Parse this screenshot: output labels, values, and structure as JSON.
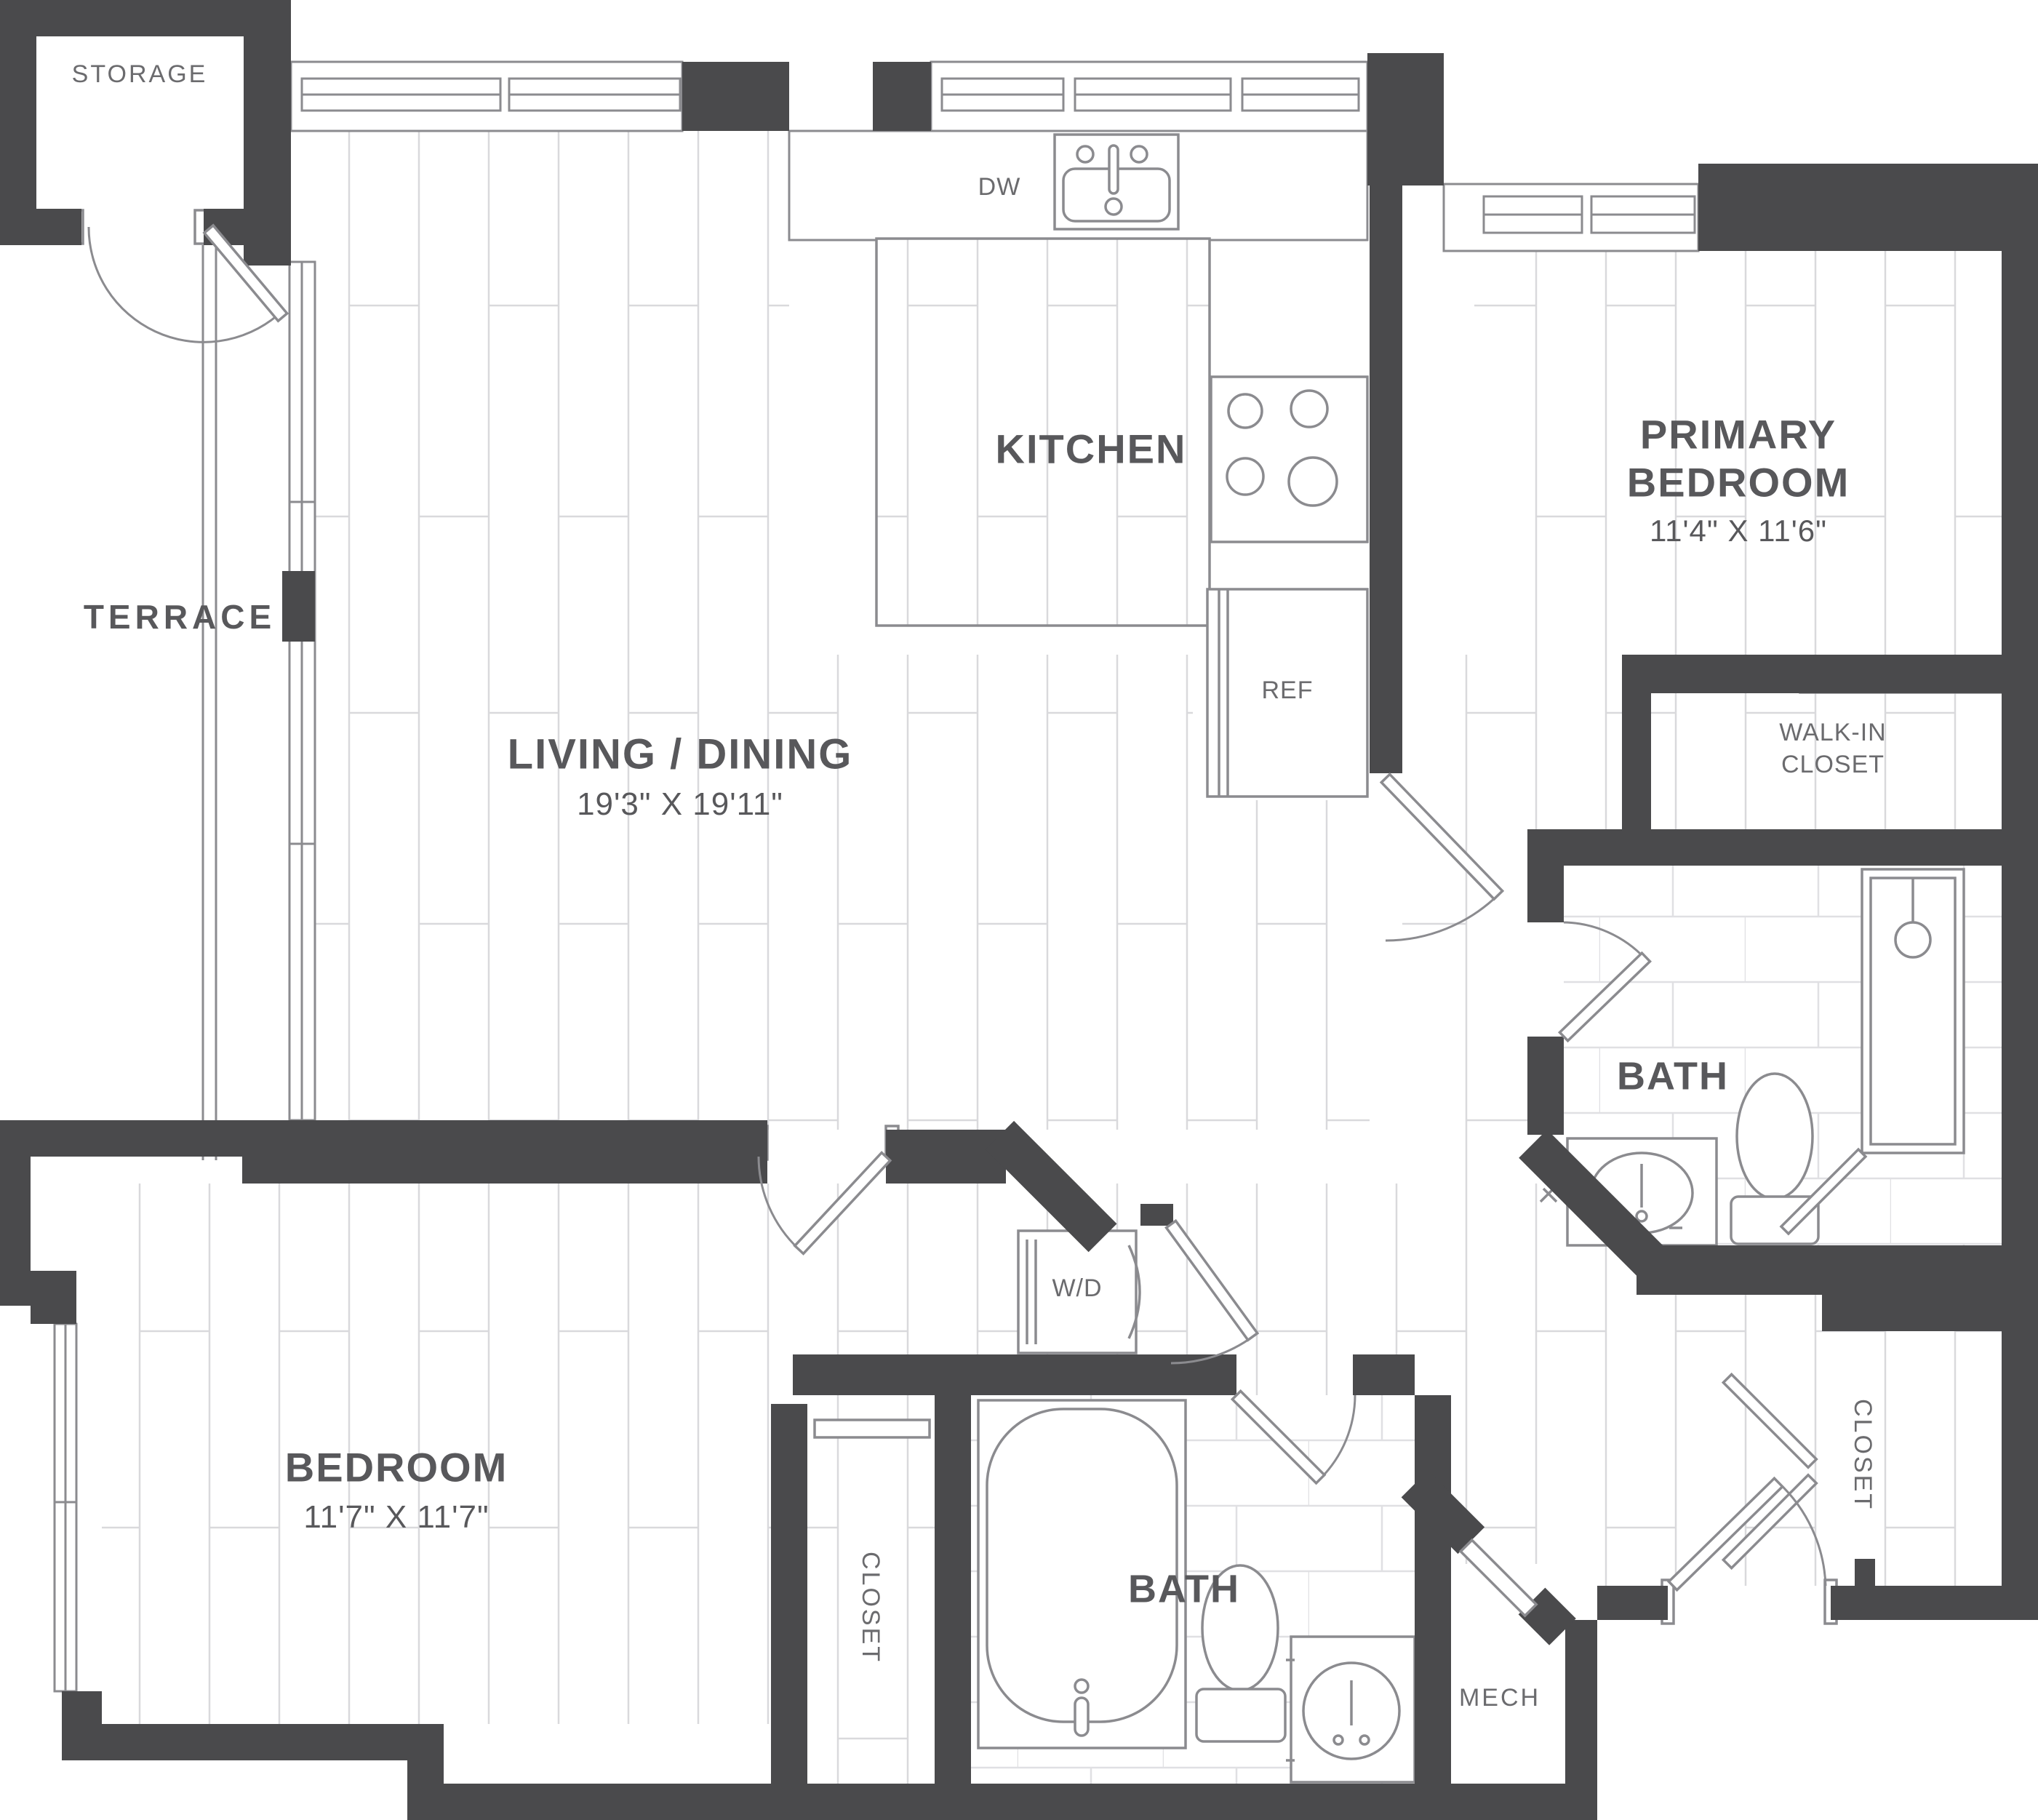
{
  "plan": {
    "title": "Two Bedroom Two Bath Floor Plan",
    "colors": {
      "wall": "#4a4a4c",
      "fixture_line": "#8b8b8f",
      "floor_line": "#d9d9dc",
      "tile_line": "#e0e0e3",
      "label_text": "#58585b"
    },
    "labels": {
      "storage": "STORAGE",
      "terrace": "TERRACE",
      "living": "LIVING / DINING",
      "living_dims": "19'3\" X 19'11\"",
      "kitchen": "KITCHEN",
      "dw": "DW",
      "ref": "REF",
      "wd": "W/D",
      "primary1": "PRIMARY",
      "primary2": "BEDROOM",
      "primary_dims": "11'4\" X 11'6\"",
      "walkin1": "WALK-IN",
      "walkin2": "CLOSET",
      "primary_bath": "BATH",
      "bedroom": "BEDROOM",
      "bedroom_dims": "11'7\" X 11'7\"",
      "bedroom_closet": "CLOSET",
      "hall_bath": "BATH",
      "entry_closet": "CLOSET",
      "mech": "MECH"
    },
    "rooms": [
      {
        "name": "Storage",
        "dimensions": ""
      },
      {
        "name": "Terrace",
        "dimensions": ""
      },
      {
        "name": "Living / Dining",
        "dimensions": "19'3\" X 19'11\""
      },
      {
        "name": "Kitchen",
        "dimensions": ""
      },
      {
        "name": "Primary Bedroom",
        "dimensions": "11'4\" X 11'6\""
      },
      {
        "name": "Walk-in Closet",
        "dimensions": ""
      },
      {
        "name": "Primary Bath",
        "dimensions": ""
      },
      {
        "name": "Bedroom",
        "dimensions": "11'7\" X 11'7\""
      },
      {
        "name": "Bedroom Closet",
        "dimensions": ""
      },
      {
        "name": "Hall Bath",
        "dimensions": ""
      },
      {
        "name": "Entry Closet",
        "dimensions": ""
      },
      {
        "name": "Mech",
        "dimensions": ""
      }
    ],
    "fixtures": [
      "Dishwasher (DW)",
      "Kitchen Sink",
      "Range",
      "Refrigerator (REF)",
      "Washer/Dryer (W/D)",
      "Shower",
      "Two Toilets",
      "Two Vanity Sinks",
      "Tub"
    ]
  }
}
